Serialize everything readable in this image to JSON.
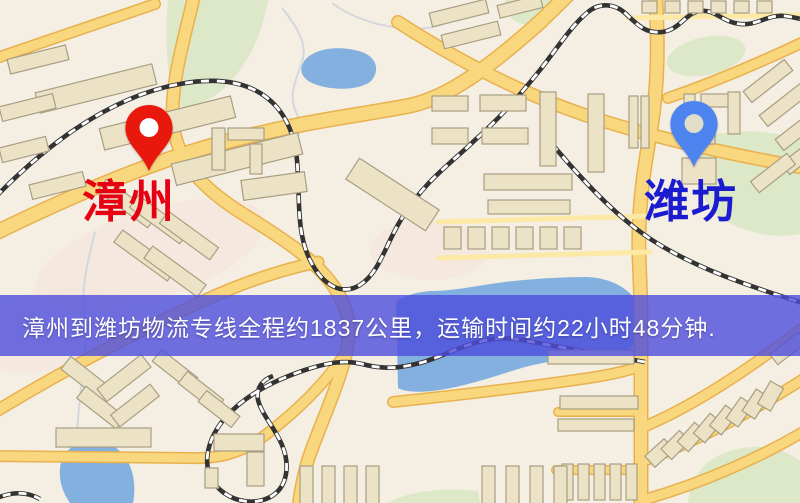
{
  "route_banner": {
    "text": "漳州到潍坊物流专线全程约1837公里，运输时间约22小时48分钟.",
    "origin": "漳州",
    "destination": "潍坊",
    "distance": "约1837公里",
    "duration": "约22小时48分钟"
  },
  "markers": {
    "origin": {
      "label": "漳州",
      "pin_color": "#e8180c",
      "pin_hole_color": "#ffffff"
    },
    "destination": {
      "label": "潍坊",
      "pin_color": "#4e84f0",
      "pin_hole_color": "#e2ddc8"
    }
  },
  "colors": {
    "map_bg": "#f5eee3",
    "road": "#f9d77e",
    "road_casing": "#e8b14d",
    "road_minor": "#fce9a6",
    "building": "#ece2c6",
    "building_stroke": "#a89e82",
    "park": "#dce8c8",
    "water": "#84b0e0",
    "rail": "#333333",
    "banner_bg": "#4d4ddc",
    "banner_text": "#ffffff",
    "origin_label": "#e60012",
    "dest_label": "#1b1bd0"
  }
}
